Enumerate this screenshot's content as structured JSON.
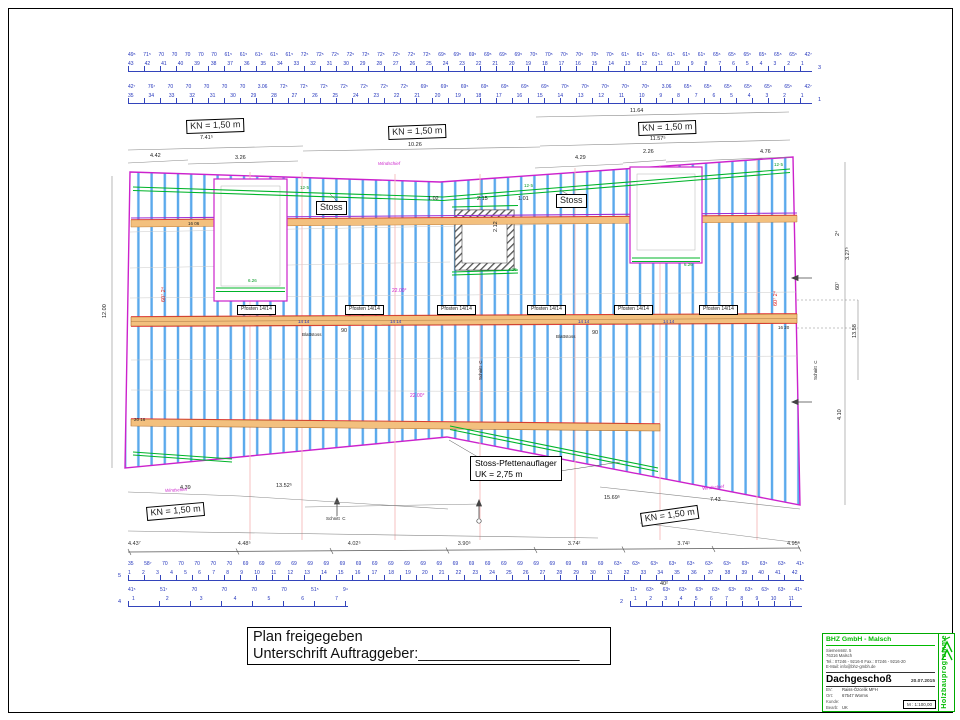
{
  "strips": {
    "top_row3": {
      "spacings": "49⁵ 71⁵ 70 70 70 70 70 61⁵ 61⁵ 61⁵ 61⁵ 61⁵ 72⁵ 72⁵ 72⁵ 72⁵ 72⁵ 72⁵ 72⁵ 72⁵ 72⁵ 69⁵ 69⁵ 69⁵ 69⁵ 69⁵ 69⁵ 70⁵ 70⁵ 70⁵ 70⁵ 70⁵ 70⁵ 61⁵ 61⁵ 61⁵ 61⁵ 61⁵ 61⁵ 65⁵ 65⁵ 65⁵ 65⁵ 65⁵ 65⁵ 42⁷",
      "ticks": "43 42 41 40 39 38 37 36 35 34 33 32 31 30 29 28 27 26 25 24 23 22 21 20 19 18 17 16 15 14 13 12 11 10 9 8 7 6 5 4 3 2 1"
    },
    "top_row1": {
      "spacings": "42⁷ 76⁷ 70 70 70 70 70 3.06 72⁵ 72⁵ 72⁵ 72⁵ 72⁵ 72⁵ 72⁵ 69⁵ 69⁵ 69⁵ 69⁵ 69⁵ 69⁵ 69⁵ 70⁵ 70⁵ 70⁵ 70⁵ 70⁵ 3.06 65⁵ 65⁵ 65⁵ 65⁵ 65⁵ 65⁵ 42⁷",
      "ticks": "35 34 33 32 31 30 29 28 27 26 25 24 23 22 21 20 19 18 17 16 15 14 13 12 11 10 9 8 7 6 5 4 3 2 1"
    },
    "bottom_main": {
      "values": "4.43⁷ 4.48⁵ 4.02⁵ 3.90⁵ 3.74² 3.74¹ 4.95⁵"
    },
    "row5": {
      "spacings": "35 58⁷ 70 70 70 70 70 69 69 69 69 69 69 69 69 69 69 69 69 69 69 69 69 69 69 69 69 69 69 69 63⁵ 63⁵ 63⁵ 63⁵ 63⁵ 63⁵ 63⁵ 63⁵ 63⁵ 63⁵ 41⁵",
      "ticks": "1 2 3 4 5 6 7 8 9 10 11 12 13 14 15 16 17 18 19 20 21 22 23 24 25 26 27 28 29 30 31 32 33 34 35 36 37 38 39 40 41 42"
    },
    "row4": {
      "spacings": "41⁵ 51⁷ 70 70 70 70 51⁵ 9⁴",
      "ticks": "1 2 3 4 5 6 7"
    },
    "row2": {
      "spacings": "11⁵ 63⁵ 63⁵ 63⁵ 63⁵ 63⁵ 63⁵ 63⁵ 63⁵ 63⁵ 41⁵",
      "ticks": "1 2 3 4 5 6 7 8 9 10 11"
    }
  },
  "plan": {
    "stoss_pfetten1": "Stoss-Pfettenauflager",
    "stoss_pfetten2": "UK = 2,75 m"
  },
  "labels": [
    {
      "t": "11.64",
      "x": 630,
      "y": 109
    },
    {
      "t": "7.41⁵",
      "x": 200,
      "y": 136
    },
    {
      "t": "10.26",
      "x": 408,
      "y": 143
    },
    {
      "t": "11.57⁵",
      "x": 650,
      "y": 137
    },
    {
      "t": "4.42",
      "x": 150,
      "y": 154
    },
    {
      "t": "3.26",
      "x": 235,
      "y": 156
    },
    {
      "t": "4.29",
      "x": 575,
      "y": 156
    },
    {
      "t": "2.26",
      "x": 643,
      "y": 150
    },
    {
      "t": "4.76",
      "x": 760,
      "y": 150
    },
    {
      "t": "1.02",
      "x": 428,
      "y": 197
    },
    {
      "t": "2.15",
      "x": 477,
      "y": 197
    },
    {
      "t": "1.01",
      "x": 518,
      "y": 197
    },
    {
      "t": "2.12",
      "x": 494,
      "y": 232,
      "r": -90
    },
    {
      "t": "4.39",
      "x": 180,
      "y": 486
    },
    {
      "t": "13.52⁵",
      "x": 276,
      "y": 484
    },
    {
      "t": "15.69⁵",
      "x": 604,
      "y": 496
    },
    {
      "t": "7.43",
      "x": 710,
      "y": 498
    },
    {
      "t": "12.00",
      "x": 103,
      "y": 318,
      "r": -90
    },
    {
      "t": "2⁴",
      "x": 836,
      "y": 236,
      "r": -90
    },
    {
      "t": "3.27⁵",
      "x": 846,
      "y": 260,
      "r": -90
    },
    {
      "t": "60⁷",
      "x": 836,
      "y": 290,
      "r": -90
    },
    {
      "t": "13.58",
      "x": 853,
      "y": 338,
      "r": -90
    },
    {
      "t": "4.10",
      "x": 838,
      "y": 420,
      "r": -90
    },
    {
      "t": "60⁷ 2⁴",
      "x": 162,
      "y": 302,
      "r": -90,
      "c": "red"
    },
    {
      "t": "60⁷ 2⁴",
      "x": 774,
      "y": 306,
      "r": -90,
      "c": "red"
    },
    {
      "t": "12·5",
      "x": 300,
      "y": 186,
      "c": "green",
      "s": 4.5
    },
    {
      "t": "12·5",
      "x": 524,
      "y": 184,
      "c": "green",
      "s": 4.5
    },
    {
      "t": "12·5",
      "x": 774,
      "y": 163,
      "c": "green",
      "s": 4.5
    },
    {
      "t": "4.26",
      "x": 508,
      "y": 268,
      "c": "green",
      "s": 4.5
    },
    {
      "t": "6.26",
      "x": 248,
      "y": 279,
      "c": "green",
      "s": 4.5
    },
    {
      "t": "6.26",
      "x": 684,
      "y": 263,
      "c": "green",
      "s": 4.5
    },
    {
      "t": "22.00°",
      "x": 392,
      "y": 289,
      "c": "magenta",
      "s": 5
    },
    {
      "t": "22.00°",
      "x": 410,
      "y": 394,
      "c": "magenta",
      "s": 5
    },
    {
      "t": "Windschief",
      "x": 378,
      "y": 162,
      "c": "magenta ital",
      "s": 4.5
    },
    {
      "t": "Windschief",
      "x": 165,
      "y": 489,
      "c": "magenta ital",
      "s": 4.5,
      "r": -3
    },
    {
      "t": "Windschief",
      "x": 702,
      "y": 487,
      "c": "magenta ital",
      "s": 4.5,
      "r": -6
    },
    {
      "t": "Blattstoss",
      "x": 302,
      "y": 333,
      "s": 4.5
    },
    {
      "t": "90",
      "x": 341,
      "y": 329
    },
    {
      "t": "Blattstoss",
      "x": 556,
      "y": 335,
      "s": 4.5
    },
    {
      "t": "90",
      "x": 592,
      "y": 331
    },
    {
      "t": "14 14",
      "x": 298,
      "y": 320,
      "c": "blue",
      "s": 4.5
    },
    {
      "t": "14 14",
      "x": 390,
      "y": 320,
      "c": "blue",
      "s": 4.5
    },
    {
      "t": "14 14",
      "x": 578,
      "y": 320,
      "c": "blue",
      "s": 4.5
    },
    {
      "t": "14 14",
      "x": 663,
      "y": 320,
      "c": "blue",
      "s": 4.5
    },
    {
      "t": "16 06",
      "x": 188,
      "y": 222,
      "s": 4.5
    },
    {
      "t": "16 20",
      "x": 778,
      "y": 326,
      "s": 4.5
    },
    {
      "t": "20 16",
      "x": 134,
      "y": 418,
      "s": 4.5
    },
    {
      "t": "Schnitt  C",
      "x": 479,
      "y": 380,
      "r": -90,
      "s": 4.5
    },
    {
      "t": "Schnitt  C",
      "x": 814,
      "y": 380,
      "r": -90,
      "s": 4.5
    },
    {
      "t": "Schnitt  C",
      "x": 326,
      "y": 517,
      "s": 4.5
    },
    {
      "t": "40²",
      "x": 660,
      "y": 582
    },
    {
      "t": "3",
      "x": 818,
      "y": 66,
      "c": "blue"
    },
    {
      "t": "1",
      "x": 818,
      "y": 98,
      "c": "blue"
    },
    {
      "t": "5",
      "x": 118,
      "y": 574,
      "c": "blue"
    },
    {
      "t": "4",
      "x": 118,
      "y": 600,
      "c": "blue"
    },
    {
      "t": "2",
      "x": 620,
      "y": 600,
      "c": "blue"
    },
    {
      "t": "KN = 1,50 m",
      "x": 186,
      "y": 120,
      "s": 9,
      "b": 1,
      "r": -2
    },
    {
      "t": "KN = 1,50 m",
      "x": 388,
      "y": 126,
      "s": 9,
      "b": 1,
      "r": -2
    },
    {
      "t": "KN = 1,50 m",
      "x": 638,
      "y": 122,
      "s": 9,
      "b": 1,
      "r": -2
    },
    {
      "t": "KN = 1,50 m",
      "x": 146,
      "y": 507,
      "s": 9,
      "b": 1,
      "r": -5
    },
    {
      "t": "KN = 1,50 m",
      "x": 640,
      "y": 513,
      "s": 9,
      "b": 1,
      "r": -8
    },
    {
      "t": "Stoss",
      "x": 316,
      "y": 201,
      "s": 9,
      "b": 1
    },
    {
      "t": "Stoss",
      "x": 556,
      "y": 194,
      "s": 9,
      "b": 1
    },
    {
      "t": "Pfosten 14/14",
      "x": 237,
      "y": 305,
      "s": 5,
      "b": 1
    },
    {
      "t": "Pfosten 14/14",
      "x": 345,
      "y": 305,
      "s": 5,
      "b": 1
    },
    {
      "t": "Pfosten 14/14",
      "x": 437,
      "y": 305,
      "s": 5,
      "b": 1
    },
    {
      "t": "Pfosten 14/14",
      "x": 527,
      "y": 305,
      "s": 5,
      "b": 1
    },
    {
      "t": "Pfosten 14/14",
      "x": 614,
      "y": 305,
      "s": 5,
      "b": 1
    },
    {
      "t": "Pfosten 14/14",
      "x": 699,
      "y": 305,
      "s": 5,
      "b": 1
    }
  ],
  "sign_box": {
    "line1": "Plan freigegeben",
    "line2": "Unterschrift Auftraggeber:____________________"
  },
  "title_block": {
    "company": "BHZ GmbH - Malsch",
    "address1": "Siemensstr. 5",
    "address2": "76316 Malsch",
    "tel": "Tel.: 07246 - 9216-0  Fax.: 07246 - 9216-20",
    "email": "E-Mail: info@bhz-gmbh.de",
    "title": "Dachgeschoß",
    "date": "20.07.2015",
    "bv_label": "BV:",
    "bv": "Raiss-Özcelik MFH",
    "ort_label": "Ort:",
    "ort": "67547 Worms",
    "kunde_label": "Kunde:",
    "kunde": "",
    "bearb_label": "Bearb:",
    "bearb": "UK",
    "scale": "M : 1:100,00",
    "vertical": "Holzbauprogramme"
  }
}
